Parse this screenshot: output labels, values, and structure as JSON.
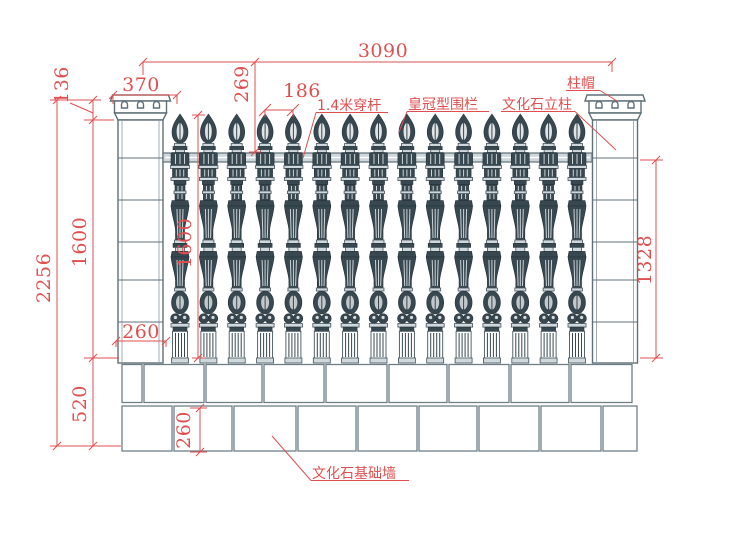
{
  "drawing_title": "皇冠型围栏立面图",
  "colors": {
    "dimension_red": "#e04f4f",
    "structure_gray": "#5f7078",
    "block_gray": "#6e7f88",
    "baluster_dark": "#374850",
    "rail_gray": "#cdd6da",
    "background": "#ffffff"
  },
  "dimensions": {
    "overall_width": "3090",
    "column_cap_width": "370",
    "column_cap_height": "136",
    "total_height": "2256",
    "column_body_height": "1600",
    "foundation_height": "520",
    "top_rail_offset": "269",
    "baluster_spacing": "186",
    "baluster_height": "1600",
    "column_block_width": "260",
    "fence_panel_height": "1328",
    "foundation_block_height": "260"
  },
  "labels": {
    "through_rod": "1.4米穿杆",
    "fence_type": "皇冠型围栏",
    "stone_column": "文化石立柱",
    "column_cap": "柱帽",
    "foundation_wall": "文化石基础墙"
  },
  "structure": {
    "baluster_count": 15,
    "column_count": 2,
    "foundation_rows": 2
  }
}
